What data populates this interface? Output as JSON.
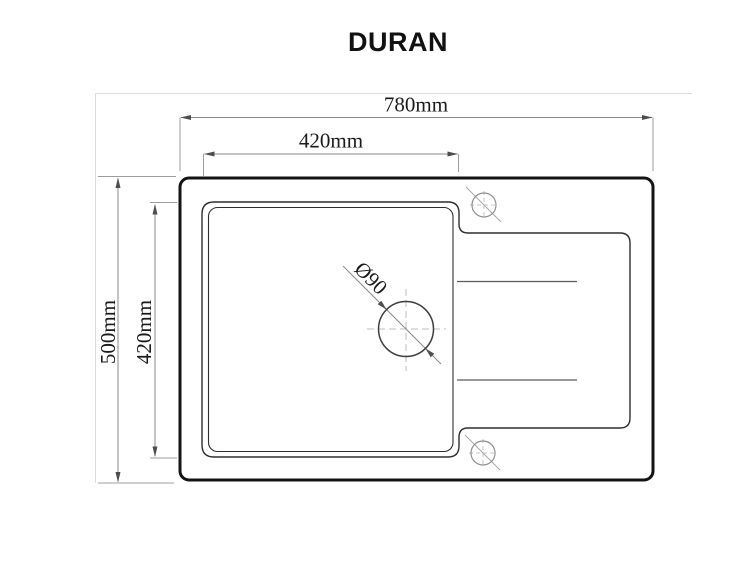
{
  "drawing": {
    "title": "DURAN",
    "type_note": "sink top-view technical drawing",
    "labels": {
      "overall_width": "780mm",
      "bowl_width": "420mm",
      "overall_depth": "500mm",
      "bowl_depth": "420mm",
      "drain_diameter": "Ø90"
    }
  },
  "colors": {
    "background": "#ffffff",
    "outline": "#141414",
    "thin_outline": "#2e2e2e",
    "dimension_line": "#8a8a8a",
    "arrow": "#4d4d4d",
    "centerline": "#bdbdbd",
    "text": "#1a1a1a"
  }
}
